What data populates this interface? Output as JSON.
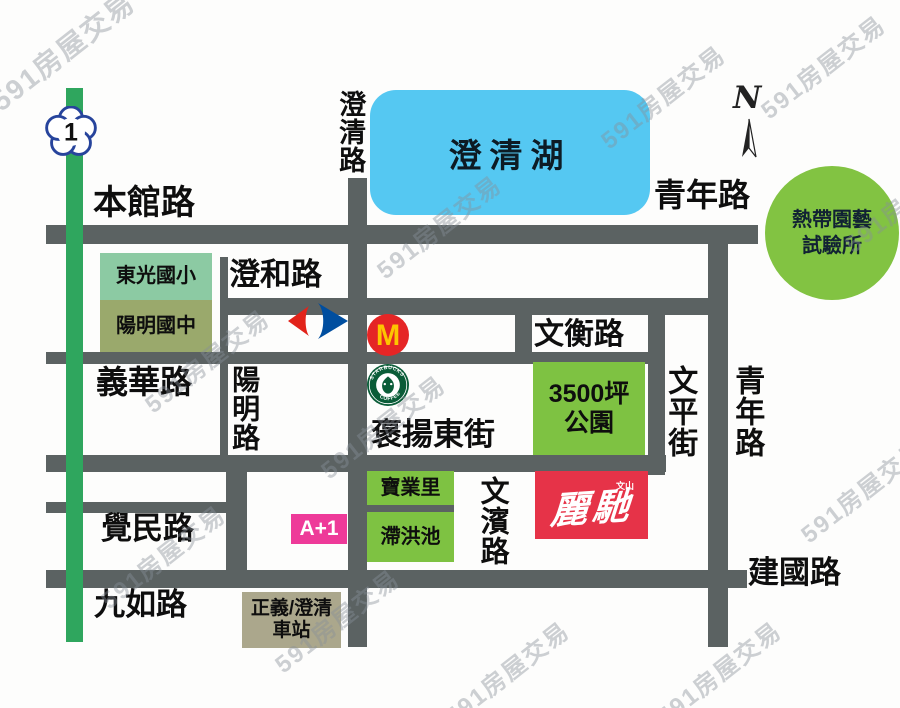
{
  "map": {
    "watermark": "591房屋交易",
    "compass": {
      "label": "N"
    },
    "highway_badge": {
      "number": "1"
    },
    "lake": {
      "label": "澄清湖"
    },
    "roads": {
      "benguan": "本館路",
      "qingnian_top": "青年路",
      "chengqing": "澄清路",
      "chenghe": "澄和路",
      "wenheng": "文衡路",
      "yihua": "義華路",
      "yangming": "陽明路",
      "baoyang": "褒揚東街",
      "wenping": "文平街",
      "qingnian_right": "青年路",
      "juemin": "覺民路",
      "wenbin": "文濱路",
      "jiuru": "九如路",
      "jianguo": "建國路"
    },
    "places": {
      "dongguang_elementary": "東光國小",
      "yangming_junior_high": "陽明國中",
      "tropical_line1": "熱帶園藝",
      "tropical_line2": "試驗所",
      "park_line1": "3500坪",
      "park_line2": "公園",
      "baoyeli": "寶業里",
      "detention_pond": "滯洪池",
      "a_plus_1": "A+1",
      "station_line1": "正義/澄清",
      "station_line2": "車站",
      "property_brand_small": "文山",
      "property_brand": "麗馳"
    },
    "logos": {
      "mcdonalds_m": "M",
      "starbucks_top": "STARBUCKS",
      "starbucks_bottom": "COFFEE"
    },
    "colors": {
      "road": "#5b6262",
      "lake": "#55c8f2",
      "green_area": "#7ec242",
      "school_elementary": "#8ccaa3",
      "school_junior": "#9aa96c",
      "station_box": "#aba78c",
      "a1_pink": "#ee3a99",
      "brand_red": "#e63348",
      "highway_green": "#2fa65e",
      "carrefour_red": "#e2231a",
      "carrefour_blue": "#004e9f",
      "mcdonalds_red": "#e52525",
      "mcdonalds_yellow": "#fdc500",
      "starbucks_green": "#0a5c38",
      "watermark_gray": "#8c949e"
    }
  }
}
